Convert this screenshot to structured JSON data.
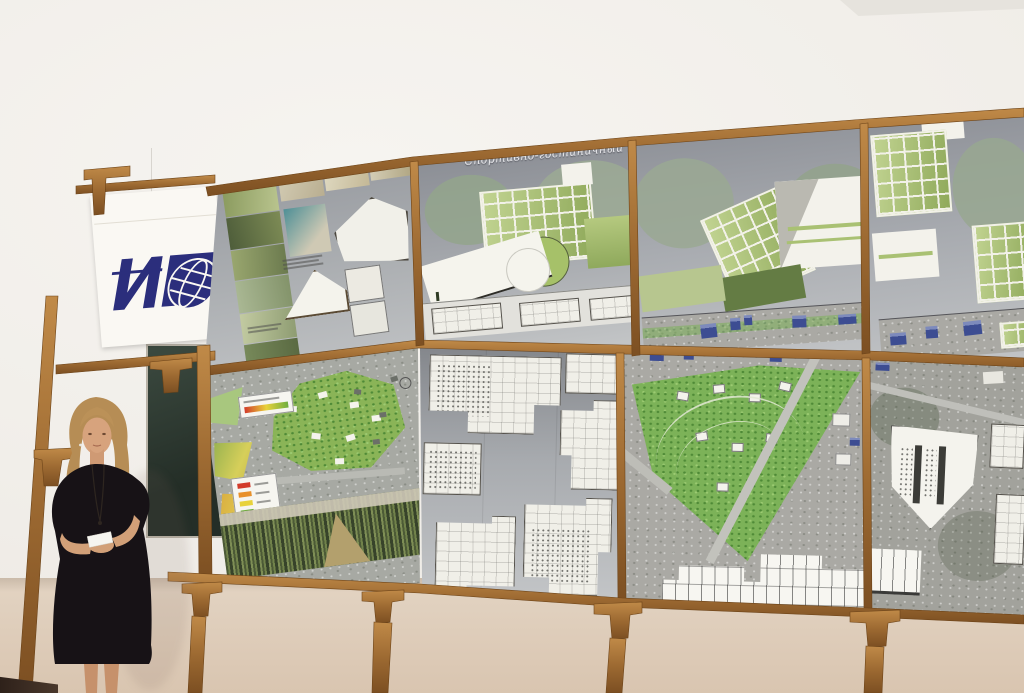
{
  "scene": {
    "kind": "photograph of a student presenting architectural competition boards",
    "board_title_full": "Спортивно-гостиничный комплекс “БОРИСОГЛЕБСКИЙ”"
  },
  "presentation": {
    "board_title_left": "Спортивно-гостиничный ко",
    "board_title_right": "мплекс “БОРИСОГЛЕБСКИЙ”"
  },
  "banner": {
    "logo_glyph": "ИГ",
    "logo_style": "navy institute logo with globe"
  },
  "colors": {
    "logo_blue": "#2b2e7c",
    "wood_frame": "#a06a34",
    "board_gray": "#a7aaae",
    "glass_green": "#a9c173",
    "park_green": "#7cb258",
    "chalkboard_green": "#2e3a31",
    "wall_upper": "#f2f0eb",
    "wall_lower": "#ddcab7",
    "aerial_blue_buildings": "#3d4d92",
    "legend_red": "#d23b2a",
    "legend_yellow": "#e8d23a",
    "legend_orange": "#e8902a",
    "legend_green": "#6fae3f",
    "dress_black": "#171216",
    "hair_blonde": "#b68d55"
  }
}
